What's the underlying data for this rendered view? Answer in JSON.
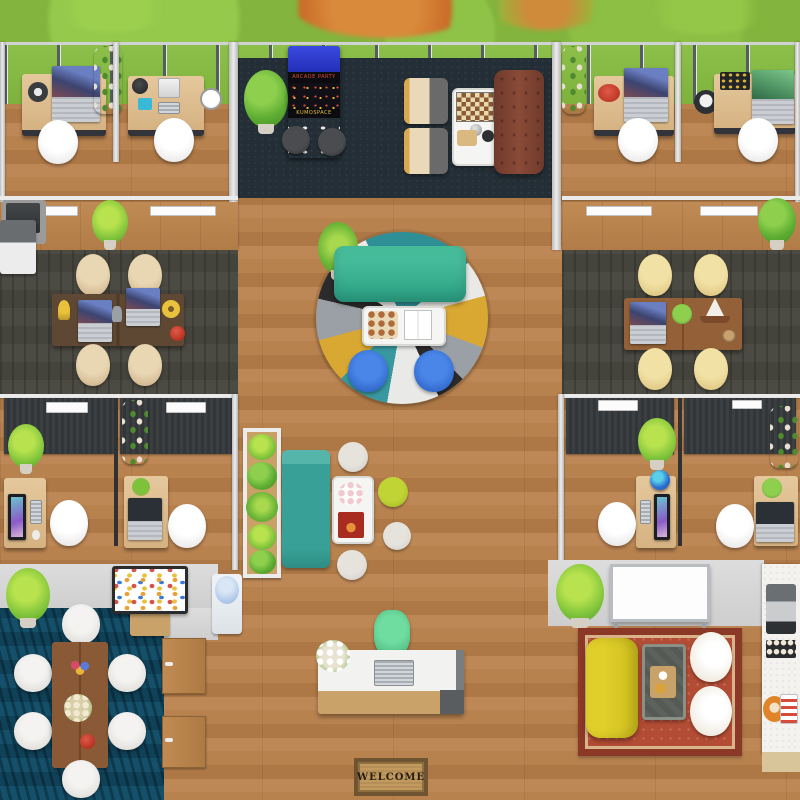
{
  "scene": {
    "type": "virtual-office-floor-plan",
    "labels": {
      "arcade_marquee": "ARCADE PARTY",
      "arcade_brand": "KUMOSPACE",
      "welcome_mat": "WELCOME"
    },
    "palette": {
      "grass": "#83b43d",
      "autumn_tree": "#cc7a2e",
      "wood_floor": "#b5804e",
      "carpet_navy": "#232e36",
      "carpet_charcoal": "#48473f",
      "carpet_blue": "#14485f",
      "wall_gray": "#d6d6d6",
      "desk_wood": "#dcbc8e",
      "teal_sofa": "#2aa184",
      "teal_daybed": "#38a096",
      "blue_chair": "#2e6fd6",
      "tan_chair": "#d9c29c",
      "yellow_chair": "#ecd88f",
      "lime_pouf": "#aec427",
      "leather_sofa": "#7e4434",
      "yellow_sofa": "#d5c422",
      "green_reception_chair": "#50c987",
      "oriental_rug_red": "#b34c34",
      "arcade_blue": "#2b3bd0"
    }
  }
}
